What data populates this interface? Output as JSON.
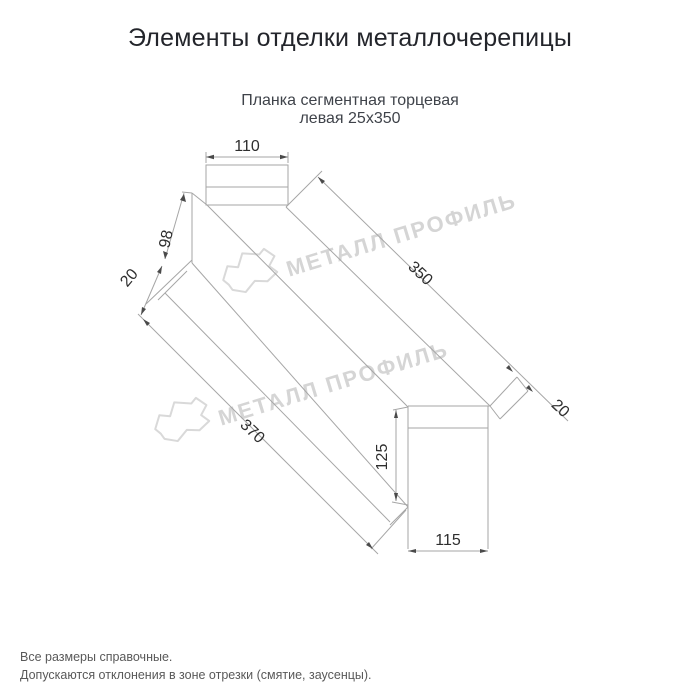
{
  "page": {
    "title": "Элементы отделки металлочерепицы",
    "subtitle_line1": "Планка сегментная торцевая",
    "subtitle_line2": "левая 25x350",
    "footnote1": "Все размеры справочные.",
    "footnote2": "Допускаются отклонения в зоне отрезки (смятие, заусенцы)."
  },
  "drawing": {
    "dims": {
      "top_width": "110",
      "left_end_height": "98",
      "left_flange": "20",
      "length_top": "350",
      "length_bottom": "370",
      "right_flange": "20",
      "right_end_height": "125",
      "bottom_width": "115"
    }
  },
  "watermark": {
    "text": "МЕТАЛЛ ПРОФИЛЬ"
  },
  "colors": {
    "line": "#a6a6a6",
    "dimension_text": "#2e2e2e",
    "watermark": "#d5d5d5",
    "title": "#23252b",
    "subtitle": "#3f434a",
    "footnote": "#595959"
  }
}
